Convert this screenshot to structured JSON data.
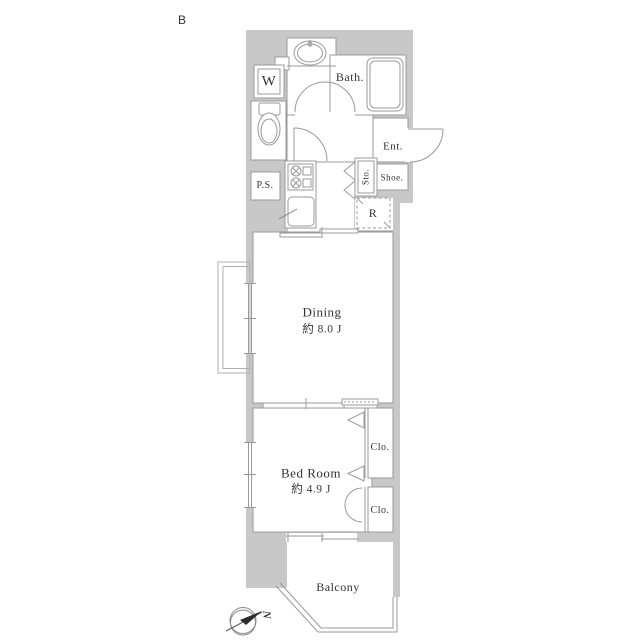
{
  "floor_plan": {
    "unit_label": "B",
    "compass": {
      "north_letter": "N"
    },
    "colors": {
      "wall_fill": "#c8c8c8",
      "outline": "#9a9a9a",
      "text": "#333333",
      "background": "#ffffff"
    },
    "rooms": {
      "dining": {
        "name": "Dining",
        "area": "約 8.0 J"
      },
      "bedroom": {
        "name": "Bed Room",
        "area": "約 4.9 J"
      },
      "balcony": {
        "name": "Balcony"
      },
      "bath": {
        "name": "Bath."
      },
      "entrance": {
        "name": "Ent."
      },
      "washer": {
        "name": "W"
      },
      "storage": {
        "name": "Sto."
      },
      "shoe_box": {
        "name": "Shoe."
      },
      "pipe_space": {
        "name": "P.S."
      },
      "refrigerator_space": {
        "name": "R"
      },
      "closet_upper": {
        "name": "Clo."
      },
      "closet_lower": {
        "name": "Clo."
      }
    }
  }
}
